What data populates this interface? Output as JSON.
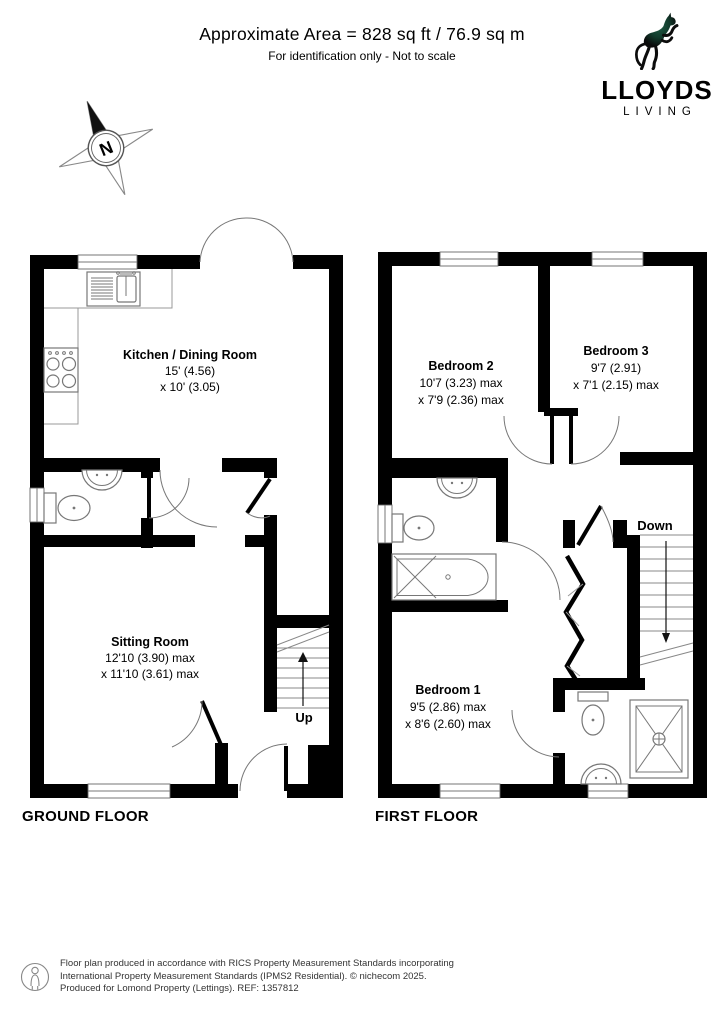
{
  "header": {
    "title": "Approximate Area = 828 sq ft / 76.9 sq m",
    "subtitle": "For identification only - Not to scale"
  },
  "logo": {
    "brand": "LLOYDS",
    "tagline": "LIVING"
  },
  "compass": {
    "north": "N"
  },
  "ground_floor": {
    "label": "GROUND FLOOR",
    "kitchen": {
      "name": "Kitchen / Dining Room",
      "dim1": "15' (4.56)",
      "dim2": "x 10' (3.05)"
    },
    "sitting": {
      "name": "Sitting Room",
      "dim1": "12'10 (3.90) max",
      "dim2": "x 11'10 (3.61) max"
    },
    "stairs_label": "Up"
  },
  "first_floor": {
    "label": "FIRST FLOOR",
    "bedroom1": {
      "name": "Bedroom 1",
      "dim1": "9'5 (2.86) max",
      "dim2": "x 8'6 (2.60) max"
    },
    "bedroom2": {
      "name": "Bedroom 2",
      "dim1": "10'7 (3.23) max",
      "dim2": "x 7'9 (2.36) max"
    },
    "bedroom3": {
      "name": "Bedroom 3",
      "dim1": "9'7 (2.91)",
      "dim2": "x 7'1 (2.15) max"
    },
    "stairs_label": "Down"
  },
  "footer": {
    "line1": "Floor plan produced in accordance with RICS Property Measurement Standards incorporating",
    "line2": "International Property Measurement Standards (IPMS2 Residential).  © nichecom 2025.",
    "line3": "Produced for Lomond Property (Lettings).   REF:  1357812"
  },
  "colors": {
    "wall": "#000000",
    "fixture_line": "#777777",
    "logo_green": "#1e5a44",
    "text": "#000000"
  }
}
